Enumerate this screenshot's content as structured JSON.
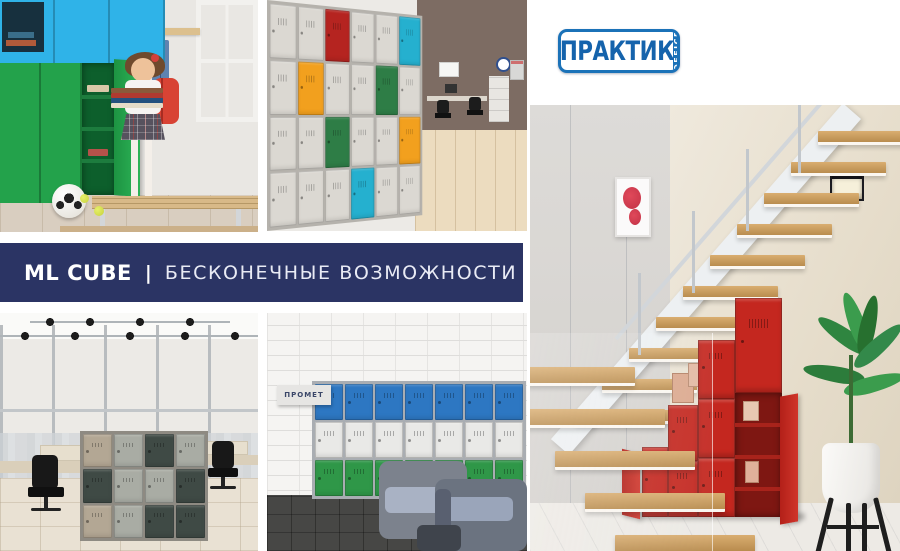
{
  "theme": {
    "page_bg": "#ffffff",
    "banner_bg": "#2b3464",
    "banner_text": "#ffffff",
    "banner_tagline_text": "#e9ebf5",
    "logo_blue": "#1b72b8",
    "logo_text_blue": "#1563ac",
    "locker_red": "#c4271f",
    "locker_green": "#23a24b",
    "locker_cyan": "#2fb3e8"
  },
  "logo": {
    "text": "ПРАКТИК",
    "tab_text": "OFFICE"
  },
  "banner": {
    "product": "ML CUBE",
    "separator": "|",
    "tagline": "БЕСКОНЕЧНЫЕ ВОЗМОЖНОСТИ"
  },
  "photos": {
    "cube_wall": {
      "palette": {
        "gray": "#dbd8d2",
        "red": "#b52420",
        "orange": "#f2a01e",
        "green": "#2e7d46",
        "teal": "#25b0cf"
      },
      "grid": [
        [
          "gray",
          "gray",
          "red",
          "gray",
          "gray",
          "teal"
        ],
        [
          "gray",
          "orange",
          "gray",
          "gray",
          "green",
          "gray"
        ],
        [
          "gray",
          "gray",
          "green",
          "gray",
          "gray",
          "orange"
        ],
        [
          "gray",
          "gray",
          "gray",
          "teal",
          "gray",
          "gray"
        ]
      ]
    },
    "office_lockers": {
      "palette": {
        "tan": "#b3a794",
        "light": "#a9aca4",
        "dark": "#3f4a45"
      },
      "grid": [
        [
          "tan",
          "light",
          "dark",
          "light"
        ],
        [
          "dark",
          "light",
          "light",
          "dark"
        ],
        [
          "tan",
          "light",
          "dark",
          "dark"
        ]
      ]
    },
    "lobby": {
      "sign": "ПРОМЕТ",
      "lockers": {
        "palette": {
          "blue": "#2d77c2",
          "white": "#e9e9e7",
          "green": "#2f9748"
        },
        "grid": [
          [
            "blue",
            "blue",
            "blue",
            "blue",
            "blue",
            "blue",
            "blue"
          ],
          [
            "white",
            "white",
            "white",
            "white",
            "white",
            "white",
            "white"
          ],
          [
            "green",
            "green",
            "green",
            "green",
            "green",
            "green",
            "green"
          ]
        ]
      }
    },
    "staircase": {
      "upper_steps": 10,
      "lower_steps": 5
    }
  }
}
